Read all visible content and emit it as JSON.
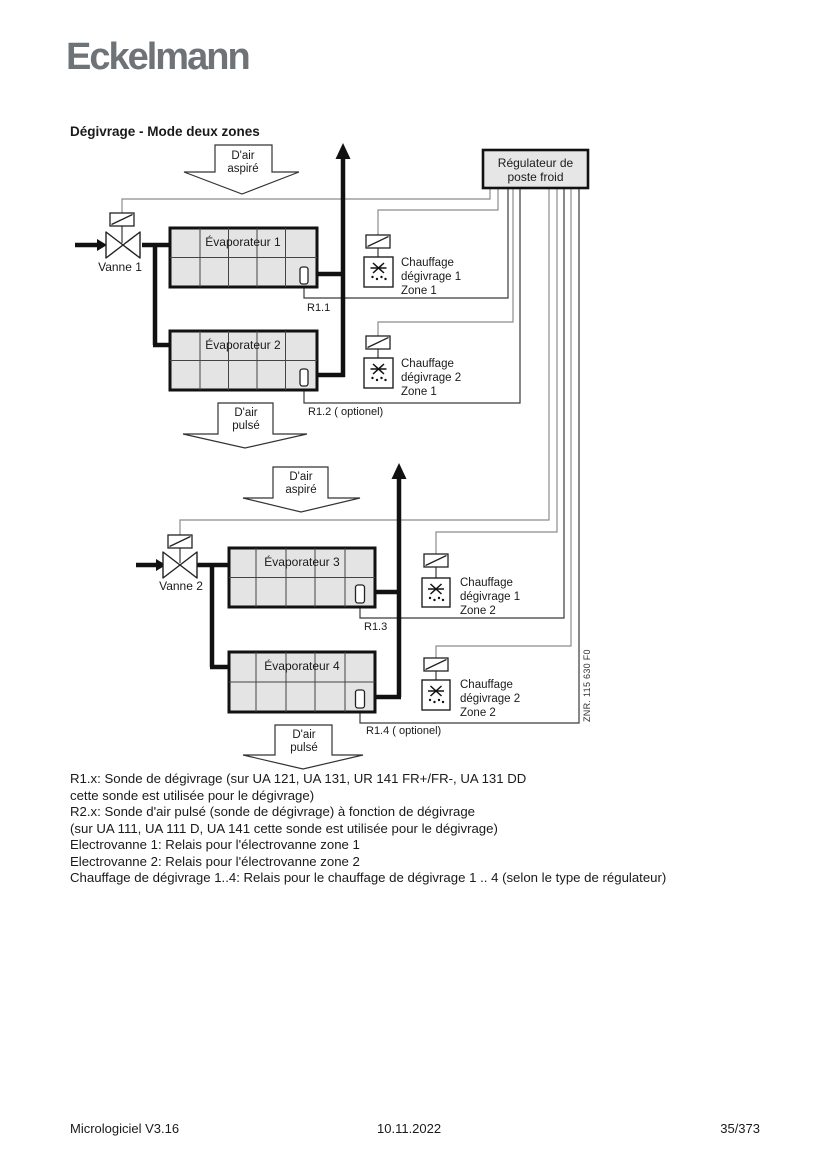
{
  "page": {
    "logo": "Eckelmann",
    "title": "Dégivrage - Mode deux zones"
  },
  "diagram": {
    "regulator": {
      "line1": "Régulateur de",
      "line2": "poste froid"
    },
    "arrows": [
      {
        "line1": "D'air",
        "line2": "aspiré"
      },
      {
        "line1": "D'air",
        "line2": "pulsé"
      },
      {
        "line1": "D'air",
        "line2": "aspiré"
      },
      {
        "line1": "D'air",
        "line2": "pulsé"
      }
    ],
    "valves": [
      {
        "label": "Vanne 1"
      },
      {
        "label": "Vanne 2"
      }
    ],
    "evaporators": [
      {
        "label": "Évaporateur 1"
      },
      {
        "label": "Évaporateur 2"
      },
      {
        "label": "Évaporateur 3"
      },
      {
        "label": "Évaporateur 4"
      }
    ],
    "heaters": [
      {
        "line1": "Chauffage",
        "line2": "dégivrage 1",
        "line3": "Zone 1"
      },
      {
        "line1": "Chauffage",
        "line2": "dégivrage 2",
        "line3": "Zone 1"
      },
      {
        "line1": "Chauffage",
        "line2": "dégivrage 1",
        "line3": "Zone 2"
      },
      {
        "line1": "Chauffage",
        "line2": "dégivrage 2",
        "line3": "Zone 2"
      }
    ],
    "sensors": [
      {
        "label": "R1.1"
      },
      {
        "label": "R1.2 ( optionel)"
      },
      {
        "label": "R1.3"
      },
      {
        "label": "R1.4 ( optionel)"
      }
    ],
    "znr": "ZNR. 115 630 F0"
  },
  "legend": {
    "lines": [
      "R1.x: Sonde de dégivrage (sur UA 121, UA 131, UR 141 FR+/FR-, UA 131 DD",
      "cette sonde est utilisée pour le dégivrage)",
      "R2.x: Sonde d'air pulsé (sonde de dégivrage) à fonction de dégivrage",
      "(sur UA 111, UA 111 D, UA 141 cette sonde est utilisée pour le dégivrage)",
      "Electrovanne 1: Relais pour l'électrovanne zone 1",
      "Electrovanne 2: Relais pour l'électrovanne zone 2",
      "Chauffage de dégivrage 1..4: Relais pour le chauffage de dégivrage 1 .. 4 (selon le type de régulateur)"
    ]
  },
  "footer": {
    "left": "Micrologiciel V3.16",
    "center": "10.11.2022",
    "right": "35/373"
  },
  "colors": {
    "logo_gray": "#6d7377",
    "box_fill": "#e6e6e6",
    "wire_gray": "#8c8c8c",
    "wire_dark": "#3a3a3a",
    "pipe_black": "#111111"
  }
}
